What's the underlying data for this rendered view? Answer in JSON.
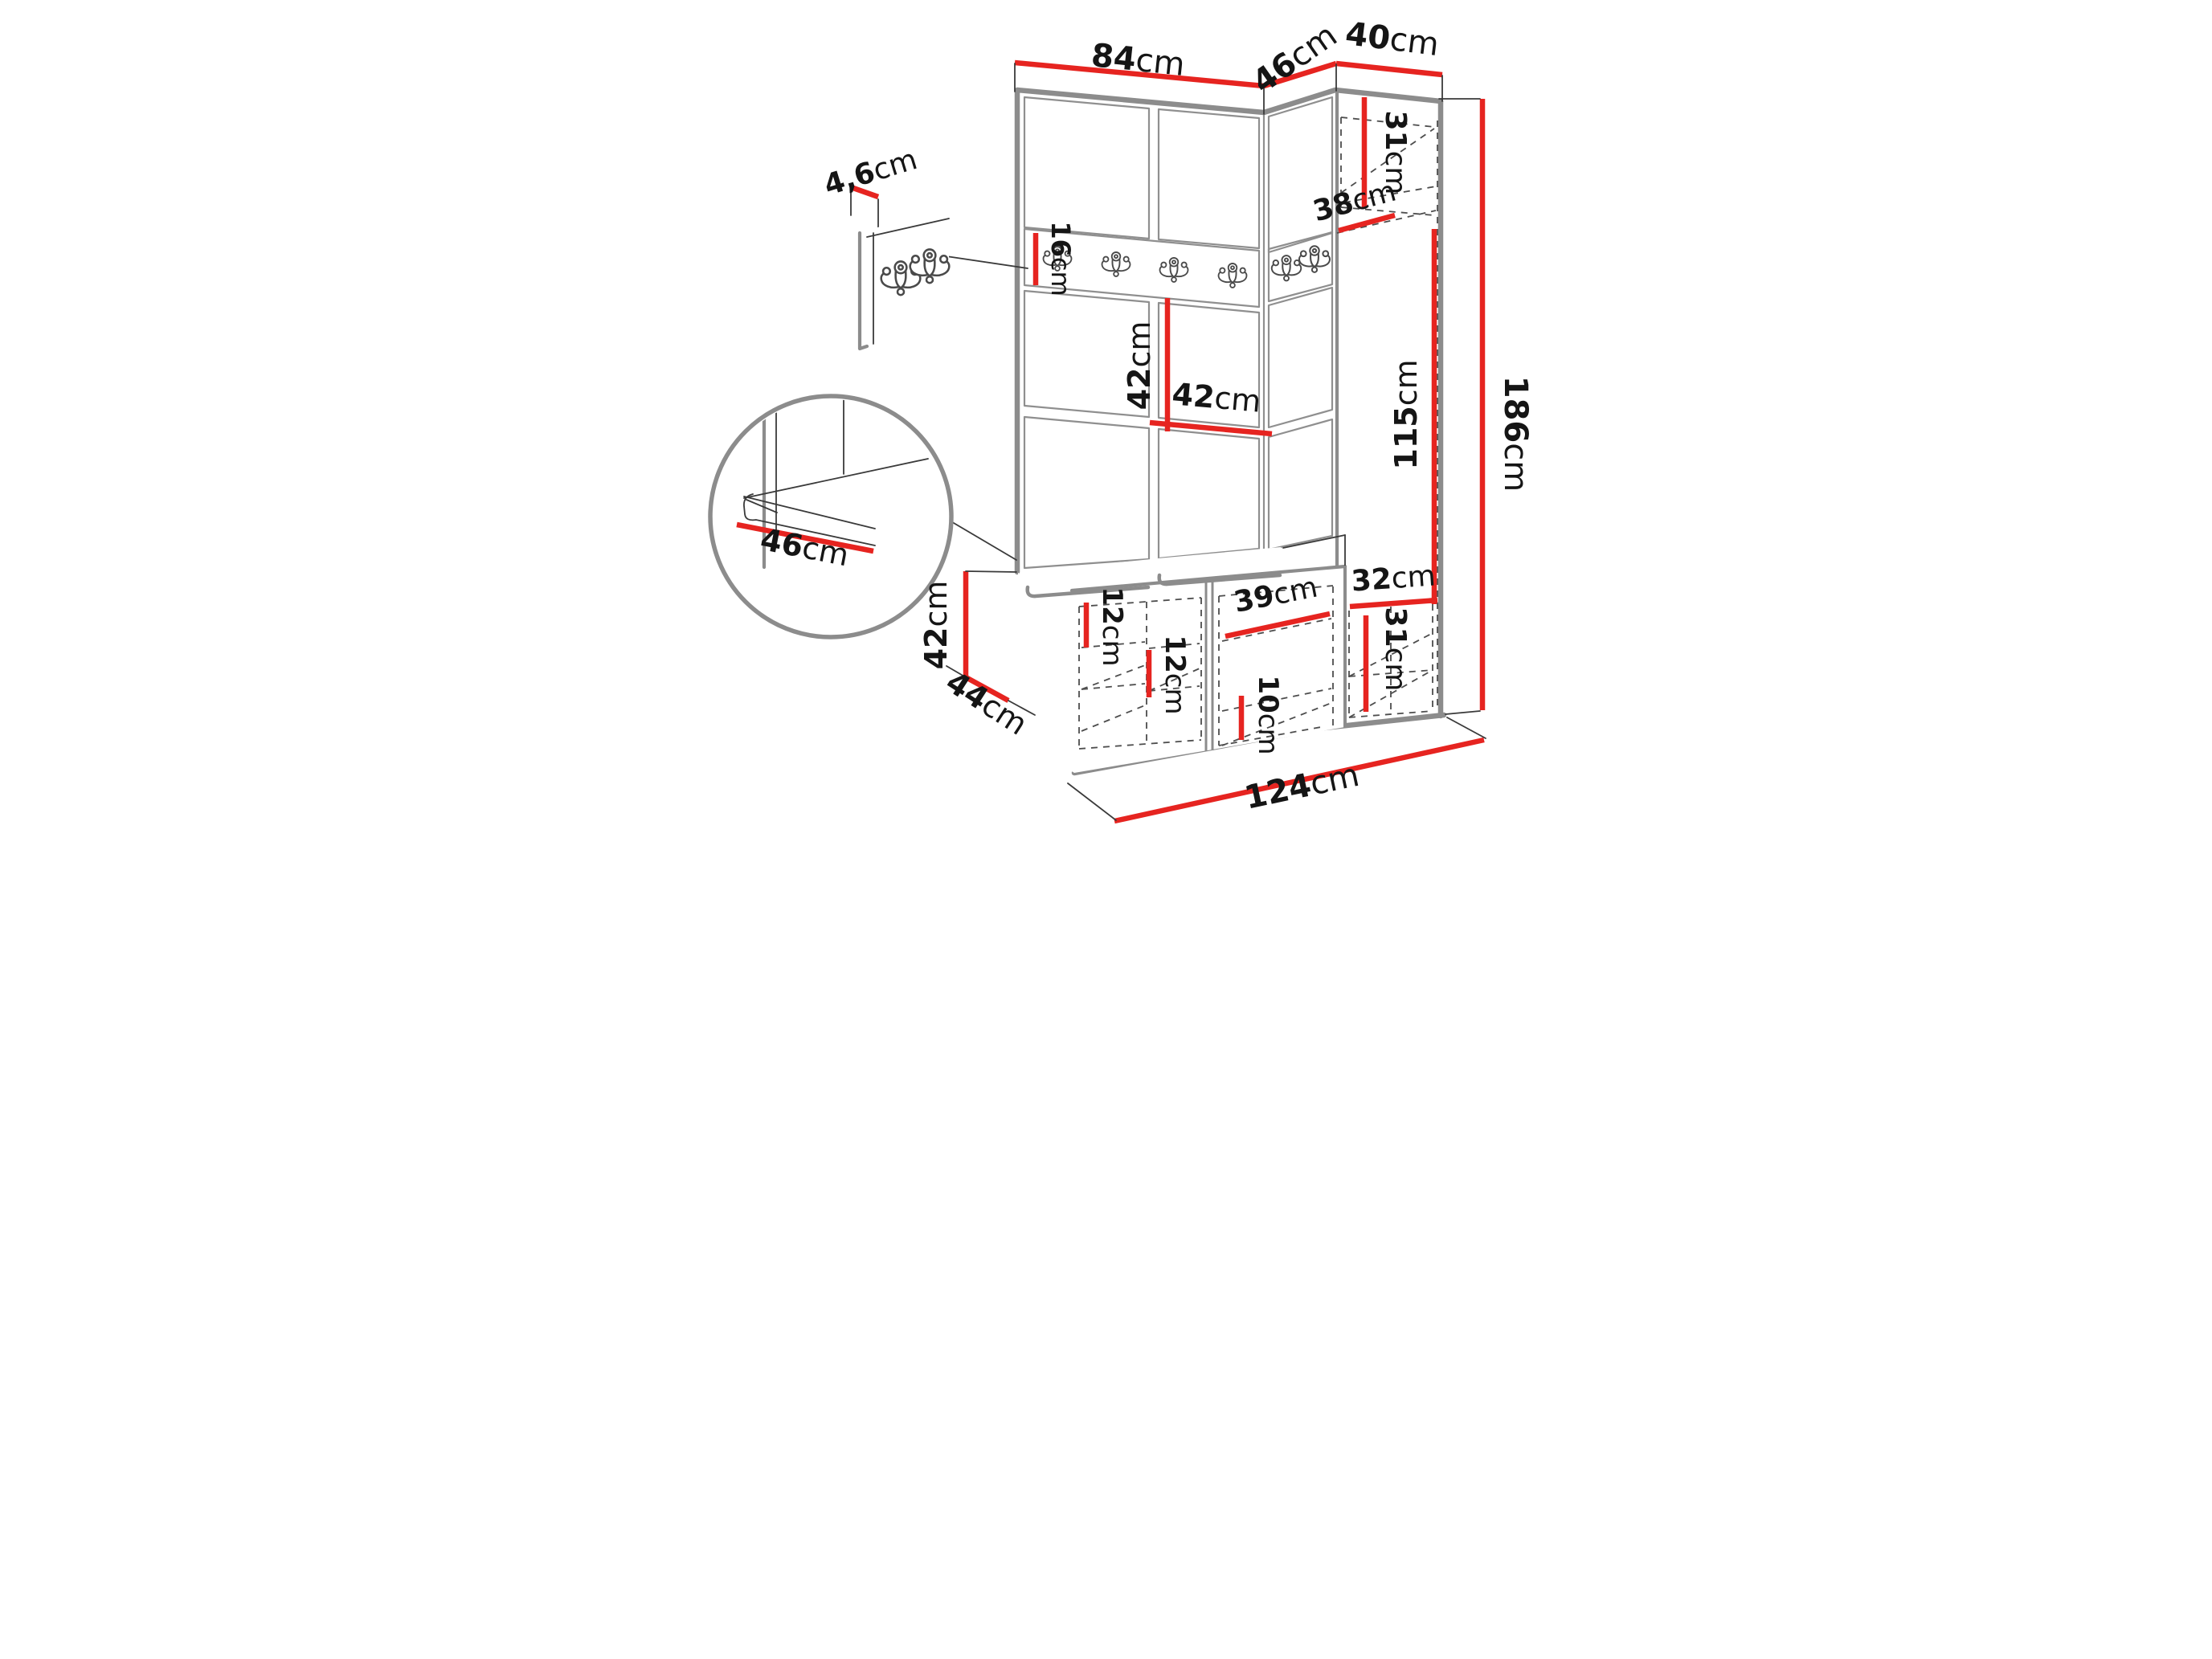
{
  "diagram_type": "furniture-dimension-drawing",
  "colors": {
    "dimension_red": "#e62420",
    "edge_gray": "#8c8c8c",
    "line_dark": "#3a3a3a"
  },
  "icons": {
    "hook": "double-coat-hook-icon"
  },
  "dims": {
    "w84": {
      "value": "84",
      "unit": "cm"
    },
    "w46": {
      "value": "46",
      "unit": "cm"
    },
    "w40": {
      "value": "40",
      "unit": "cm"
    },
    "t4_6": {
      "value": "4,6",
      "unit": "cm"
    },
    "h31_top": {
      "value": "31",
      "unit": "cm"
    },
    "d38": {
      "value": "38",
      "unit": "cm"
    },
    "h16": {
      "value": "16",
      "unit": "cm"
    },
    "h42_panel": {
      "value": "42",
      "unit": "cm"
    },
    "w42_panel": {
      "value": "42",
      "unit": "cm"
    },
    "h115": {
      "value": "115",
      "unit": "cm"
    },
    "h186": {
      "value": "186",
      "unit": "cm"
    },
    "d46_seat": {
      "value": "46",
      "unit": "cm"
    },
    "h42_bench": {
      "value": "42",
      "unit": "cm"
    },
    "d44": {
      "value": "44",
      "unit": "cm"
    },
    "w124": {
      "value": "124",
      "unit": "cm"
    },
    "g12_a": {
      "value": "12",
      "unit": "cm"
    },
    "g12_b": {
      "value": "12",
      "unit": "cm"
    },
    "w39": {
      "value": "39",
      "unit": "cm"
    },
    "g10": {
      "value": "10",
      "unit": "cm"
    },
    "w32": {
      "value": "32",
      "unit": "cm"
    },
    "h31_bot": {
      "value": "31",
      "unit": "cm"
    }
  }
}
